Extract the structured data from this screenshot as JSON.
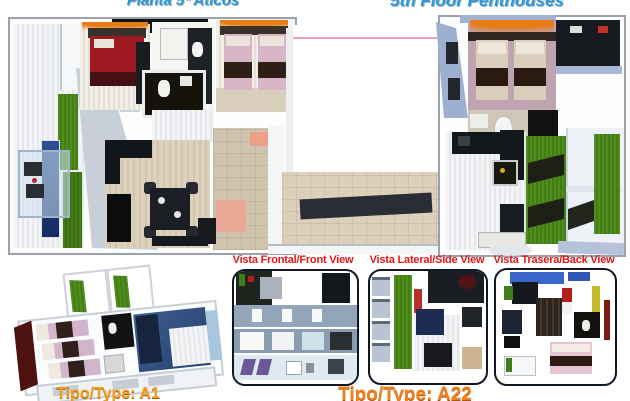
{
  "titles": {
    "left": "Planta 5ª Aticos",
    "right": "5th Floor Penthouses"
  },
  "view_labels": {
    "front": "Vista Frontal/Front View",
    "side": "Vista Lateral/Side View",
    "back": "Vista Trasera/Back View"
  },
  "type_labels": {
    "a1": "Tipo/Type: A1",
    "a22": "Tipo/Type: A22"
  },
  "colors": {
    "title_blue": "#2E97D4",
    "label_red": "#E31717",
    "type_gold": "#F0A224",
    "type_orange": "#F08122",
    "grass_green": "#4E8C1F",
    "bed_red": "#9D1B20",
    "bed_pink": "#D6B6C6",
    "floor_beige": "#D2C5AE",
    "wall_periwinkle": "#9FB2D4",
    "terrace_blue": "#2E4F8E",
    "courtyard_pink_line": "#E8A0B2"
  }
}
